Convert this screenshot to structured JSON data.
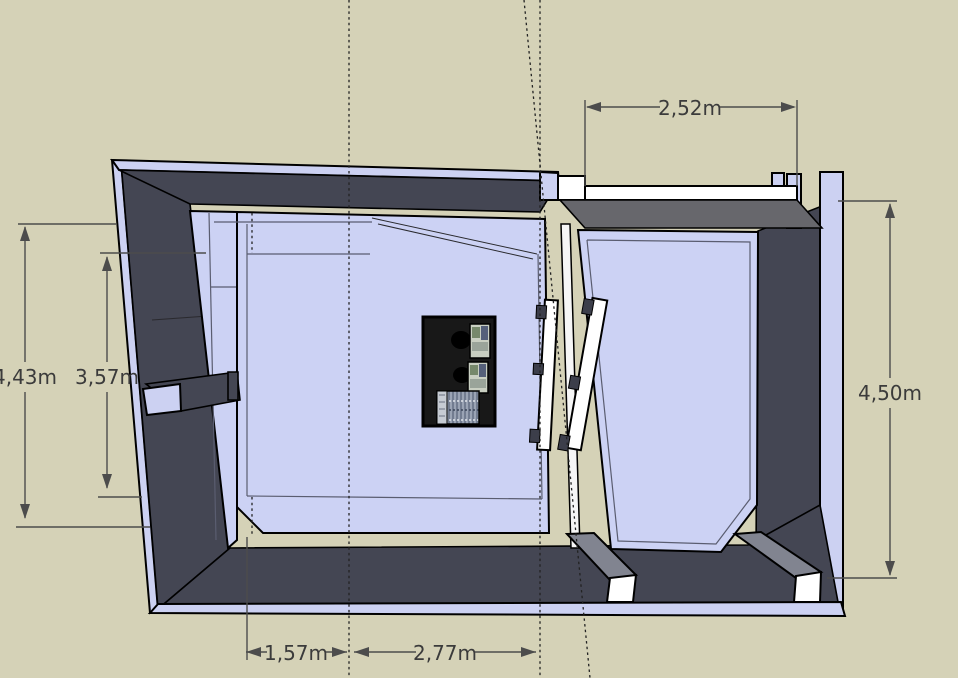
{
  "viewport": {
    "type": "floor-plan-top-view",
    "rooms": [
      "control-room",
      "live-room"
    ]
  },
  "dimensions": {
    "top_width": "2,52m",
    "left_outer_height": "4,43m",
    "left_inner_height": "3,57m",
    "right_height": "4,50m",
    "bottom_left_width": "1,57m",
    "bottom_right_width": "2,77m"
  },
  "palette": {
    "background": "#d5d2b7",
    "wall_side": "#444653",
    "wall_top_lavender": "#ccd1f2",
    "floor_lavender": "#ccd2f4",
    "wall_top_gray": "#67676c",
    "beam_white": "#ffffff",
    "desk_black": "#181818",
    "dimension_text": "#3b3b3b",
    "guide_line": "#222222"
  }
}
